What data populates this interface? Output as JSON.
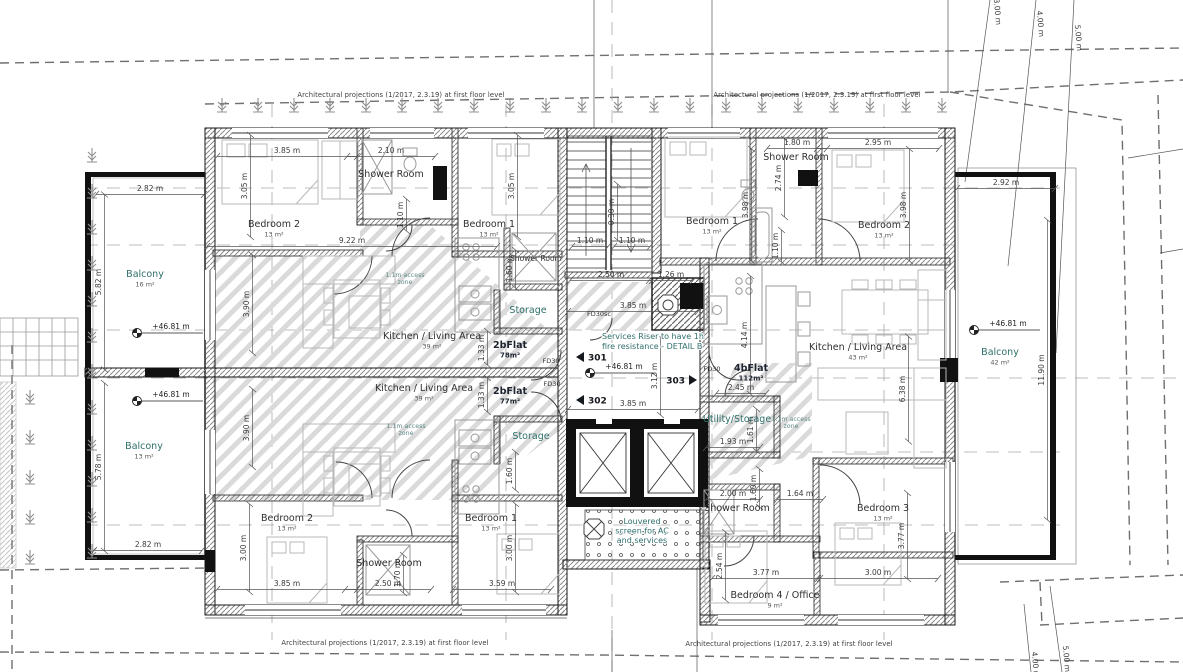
{
  "site_note": "Architectural projections (1/2017, 2.3.19) at first floor level",
  "colors": {
    "wall": "#1a1a1a",
    "hatch": "#8a8a8a",
    "teal": "#2e6f6b",
    "text": "#2e2e2e",
    "dashed": "#6f6f6f"
  },
  "rooms": [
    {
      "n": "Bedroom 2",
      "a": "13 m²",
      "x": 274,
      "y": 227
    },
    {
      "n": "Shower Room",
      "x": 391,
      "y": 177
    },
    {
      "n": "Bedroom 1",
      "a": "13 m²",
      "x": 489,
      "y": 227
    },
    {
      "n": "Shower Room",
      "x": 536,
      "y": 261,
      "s": 1
    },
    {
      "n": "Storage",
      "x": 528,
      "y": 313,
      "t": 1
    },
    {
      "n": "Kitchen / Living Area",
      "a": "39 m²",
      "x": 432,
      "y": 339
    },
    {
      "n": "2bFlat",
      "a": "78m²",
      "x": 510,
      "y": 348,
      "b": 1
    },
    {
      "n": "Kitchen / Living Area",
      "a": "39 m²",
      "x": 424,
      "y": 391
    },
    {
      "n": "2bFlat",
      "a": "77m²",
      "x": 510,
      "y": 394,
      "b": 1
    },
    {
      "n": "Bedroom 2",
      "a": "13 m²",
      "x": 287,
      "y": 521
    },
    {
      "n": "Shower Room",
      "x": 389,
      "y": 566
    },
    {
      "n": "Bedroom 1",
      "a": "13 m²",
      "x": 491,
      "y": 521
    },
    {
      "n": "Storage",
      "x": 531,
      "y": 439,
      "t": 1
    },
    {
      "n": "Balcony",
      "a": "16 m²",
      "x": 145,
      "y": 277,
      "t": 1
    },
    {
      "n": "Balcony",
      "a": "13 m²",
      "x": 144,
      "y": 449,
      "t": 1
    },
    {
      "n": "Balcony",
      "a": "42 m²",
      "x": 1000,
      "y": 355,
      "t": 1
    },
    {
      "n": "Bedroom 1",
      "a": "13 m²",
      "x": 712,
      "y": 224
    },
    {
      "n": "Shower Room",
      "x": 796,
      "y": 160
    },
    {
      "n": "Bedroom 2",
      "a": "13 m²",
      "x": 884,
      "y": 228
    },
    {
      "n": "Kitchen / Living Area",
      "a": "43 m²",
      "x": 858,
      "y": 350
    },
    {
      "n": "4bFlat",
      "a": "112m²",
      "x": 751,
      "y": 371,
      "b": 1
    },
    {
      "n": "Utility/Storage",
      "x": 737,
      "y": 422,
      "t": 1
    },
    {
      "n": "Shower Room",
      "x": 737,
      "y": 511
    },
    {
      "n": "Bedroom 3",
      "a": "13 m²",
      "x": 883,
      "y": 511
    },
    {
      "n": "Bedroom 4 / Office",
      "a": "9 m²",
      "x": 775,
      "y": 598
    }
  ],
  "dims": [
    [
      "3.85 m",
      287,
      153,
      0,
      140
    ],
    [
      "2.10 m",
      391,
      153,
      0,
      88
    ],
    [
      "9.22 m",
      352,
      243,
      0,
      290
    ],
    [
      "1.80 m",
      797,
      145,
      0,
      60
    ],
    [
      "2.95 m",
      878,
      145,
      0,
      122
    ],
    [
      "2.50 m",
      611,
      277,
      0,
      82
    ],
    [
      "1.26 m",
      671,
      277,
      0,
      44
    ],
    [
      "3.85 m",
      633,
      308,
      0,
      130
    ],
    [
      "3.85 m",
      633,
      406,
      0,
      130
    ],
    [
      "2.92 m",
      1006,
      185,
      0,
      98
    ],
    [
      "2.82 m",
      150,
      191,
      0,
      108
    ],
    [
      "2.82 m",
      148,
      547,
      0,
      108
    ],
    [
      "3.85 m",
      287,
      586,
      0,
      140
    ],
    [
      "2.50 m",
      388,
      586,
      0,
      86
    ],
    [
      "3.59 m",
      502,
      586,
      0,
      98
    ],
    [
      "3.77 m",
      766,
      575,
      0,
      108
    ],
    [
      "3.00 m",
      878,
      575,
      0,
      120
    ],
    [
      "1.93 m",
      733,
      444,
      0,
      54
    ],
    [
      "2.00 m",
      733,
      496,
      0,
      54
    ],
    [
      "1.64 m",
      800,
      496,
      0,
      46
    ],
    [
      "2.45 m",
      741,
      390,
      0,
      50
    ],
    [
      "1.10 m",
      590,
      243,
      0,
      36
    ],
    [
      "1.10 m",
      632,
      243,
      0,
      36
    ],
    [
      "3.05 m",
      247,
      186,
      -90,
      102
    ],
    [
      "3.05 m",
      514,
      186,
      -90,
      102
    ],
    [
      "3.90 m",
      249,
      304,
      -90,
      98
    ],
    [
      "3.90 m",
      249,
      428,
      -90,
      78
    ],
    [
      "3.00 m",
      246,
      548,
      -90,
      88
    ],
    [
      "3.00 m",
      512,
      548,
      -90,
      88
    ],
    [
      "1.33 m",
      484,
      348,
      -90,
      34
    ],
    [
      "1.33 m",
      484,
      395,
      -90,
      34
    ],
    [
      "5.82 m",
      101,
      282,
      -90,
      175
    ],
    [
      "5.78 m",
      101,
      467,
      -90,
      168
    ],
    [
      "3.98 m",
      748,
      205,
      -90,
      112
    ],
    [
      "3.98 m",
      906,
      205,
      -90,
      112
    ],
    [
      "2.74 m",
      781,
      178,
      -90,
      78
    ],
    [
      "1.10 m",
      778,
      246,
      -90,
      32
    ],
    [
      "4.14 m",
      747,
      335,
      -90,
      118
    ],
    [
      "3.12 m",
      657,
      376,
      -90,
      78
    ],
    [
      "6.38 m",
      905,
      389,
      -90,
      105
    ],
    [
      "3.77 m",
      904,
      536,
      -90,
      86
    ],
    [
      "2.54 m",
      722,
      566,
      -90,
      68
    ],
    [
      "1.61 m",
      753,
      430,
      -90,
      42
    ],
    [
      "1.60 m",
      756,
      488,
      -90,
      38
    ],
    [
      "1.60 m",
      512,
      269,
      -90,
      38
    ],
    [
      "1.60 m",
      512,
      471,
      -90,
      38
    ],
    [
      "1.70 m",
      400,
      574,
      -90,
      38
    ],
    [
      "0.30 m",
      614,
      212,
      -90,
      56
    ],
    [
      "1.10 m",
      403,
      215,
      -90,
      32
    ],
    [
      "11.90 m",
      1044,
      370,
      -90,
      300
    ],
    [
      "3.00 m",
      995,
      12,
      85,
      0
    ],
    [
      "4.00 m",
      1038,
      24,
      85,
      0
    ],
    [
      "5.00 m",
      1076,
      38,
      85,
      0
    ],
    [
      "5.00 m",
      1064,
      659,
      85,
      0
    ],
    [
      "4.00 m",
      1033,
      665,
      85,
      0
    ]
  ],
  "levels": {
    "label": "+46.81 m",
    "positions": [
      [
        167,
        329
      ],
      [
        167,
        397
      ],
      [
        620,
        369
      ],
      [
        1004,
        326
      ]
    ]
  },
  "markers": [
    {
      "label": "301",
      "x": 592,
      "y": 357,
      "dir": "left"
    },
    {
      "label": "302",
      "x": 592,
      "y": 400,
      "dir": "left"
    },
    {
      "label": "303",
      "x": 681,
      "y": 380,
      "dir": "right"
    }
  ],
  "fire_doors": [
    {
      "t": "FD30sc",
      "x": 599,
      "y": 316
    },
    {
      "t": "FD30",
      "x": 551,
      "y": 363
    },
    {
      "t": "FD30",
      "x": 552,
      "y": 386
    },
    {
      "t": "FD30",
      "x": 712,
      "y": 371
    }
  ],
  "notes": [
    {
      "lines": [
        "Services Riser to have 1h",
        "fire resistance - DETAIL B"
      ],
      "x": 602,
      "y": 339,
      "anchor": "start",
      "step": 10
    },
    {
      "lines": [
        "Louvered",
        "screen for AC",
        "and services"
      ],
      "x": 642,
      "y": 524,
      "anchor": "middle",
      "step": 9.5
    }
  ],
  "access_zone": {
    "lines": [
      "1.1m access",
      "zone"
    ],
    "positions": [
      [
        405,
        277
      ],
      [
        406,
        428
      ],
      [
        791,
        421
      ]
    ]
  }
}
